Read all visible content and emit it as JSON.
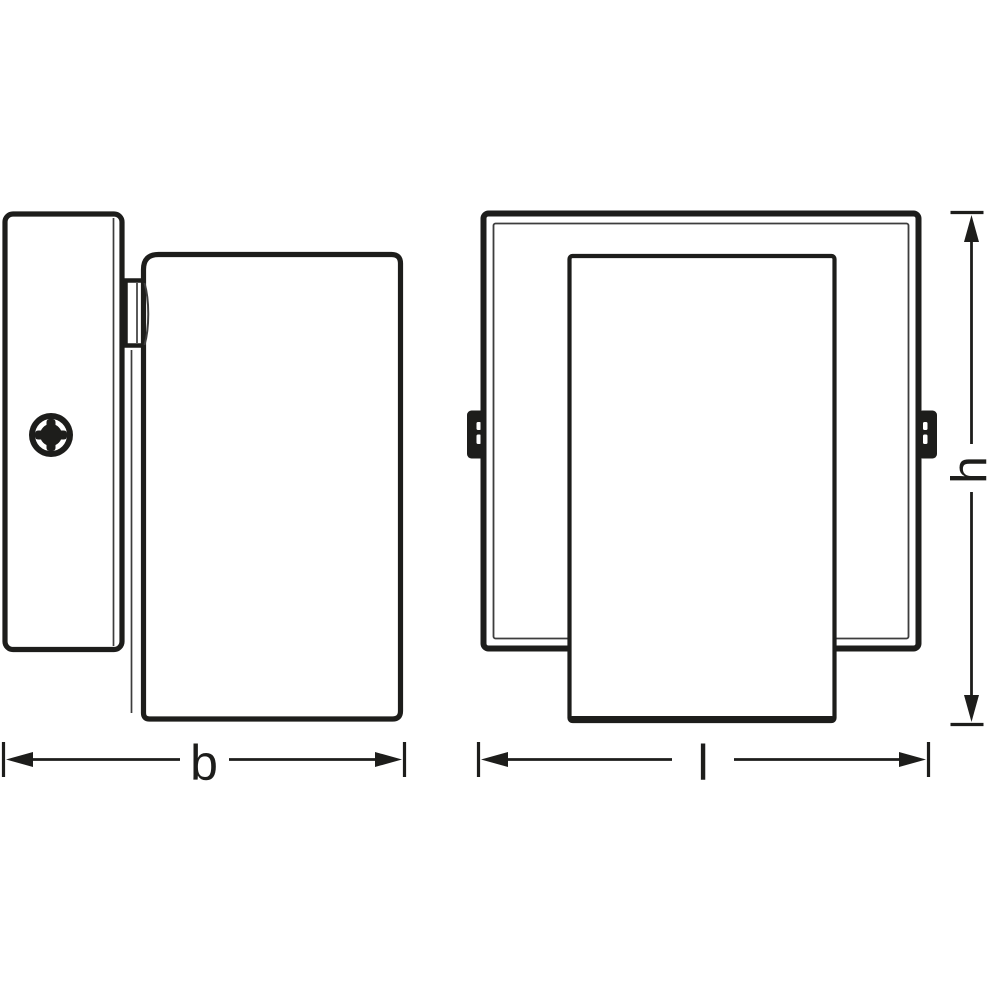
{
  "page": {
    "background": "#ffffff"
  },
  "diagram": {
    "kind": "product-dimension-drawing",
    "ink_color": "#1d1d1b",
    "thin_line_color": "#3d3d3d",
    "views": [
      {
        "id": "side-view",
        "parts": [
          "wall-plate",
          "mounting-screw",
          "hinge-bracket",
          "lamp-head"
        ]
      },
      {
        "id": "front-view",
        "parts": [
          "square-frame",
          "lamp-body",
          "pivot-tab-left",
          "pivot-tab-right"
        ]
      }
    ],
    "dimensions": [
      {
        "id": "b",
        "label": "b",
        "orientation": "horizontal"
      },
      {
        "id": "l",
        "label": "l",
        "orientation": "horizontal"
      },
      {
        "id": "h",
        "label": "h",
        "orientation": "vertical"
      }
    ]
  }
}
